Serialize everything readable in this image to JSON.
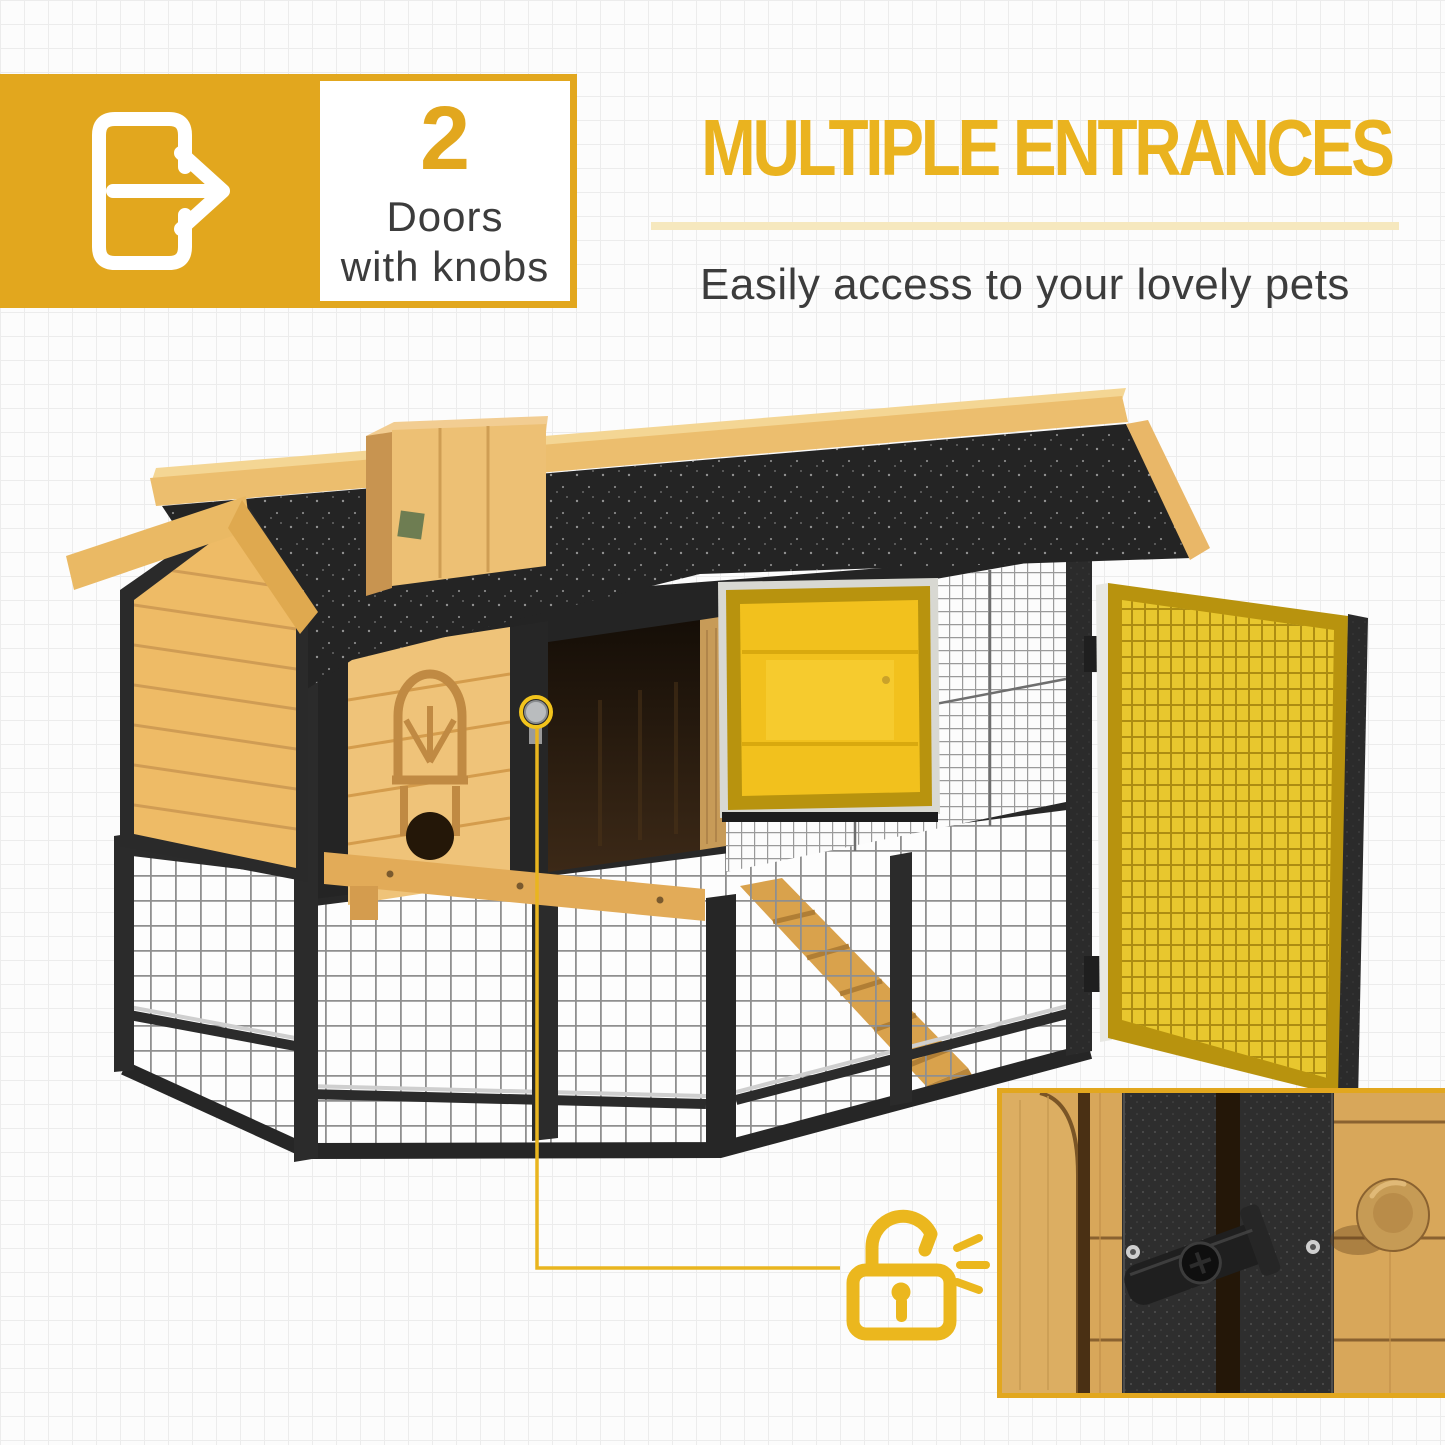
{
  "theme": {
    "accent": "#E2A71E",
    "headline": "#EAB31F",
    "divider": "#F6E8BE",
    "text_dark": "#3C3C3C",
    "annotation_line": "#EBB71E",
    "background": "#FCFCFC",
    "grid": "#ECECEC",
    "highlight_door_yellow": "#F2C11D",
    "mesh_door_yellow": "#E8C72E",
    "wood_light": "#EFC379",
    "metal_black": "#2B2B2B"
  },
  "badge": {
    "number": "2",
    "caption_line1": "Doors",
    "caption_line2": "with knobs",
    "icon": "door-enter-arrow-icon"
  },
  "header": {
    "title": "MULTIPLE ENTRANCES",
    "subtitle": "Easily access to your lovely pets"
  },
  "figure": {
    "subject": "wooden pet hutch with black wire run, asphalt roof, highlighted flip door and open mesh door",
    "callouts": {
      "knob_marker": "yellow circle around door knob",
      "connector": "yellow line from knob to padlock icon",
      "lock_icon": "padlock-unlocked-icon with sound dashes",
      "inset": "close-up photo of latch and wooden knob"
    }
  }
}
